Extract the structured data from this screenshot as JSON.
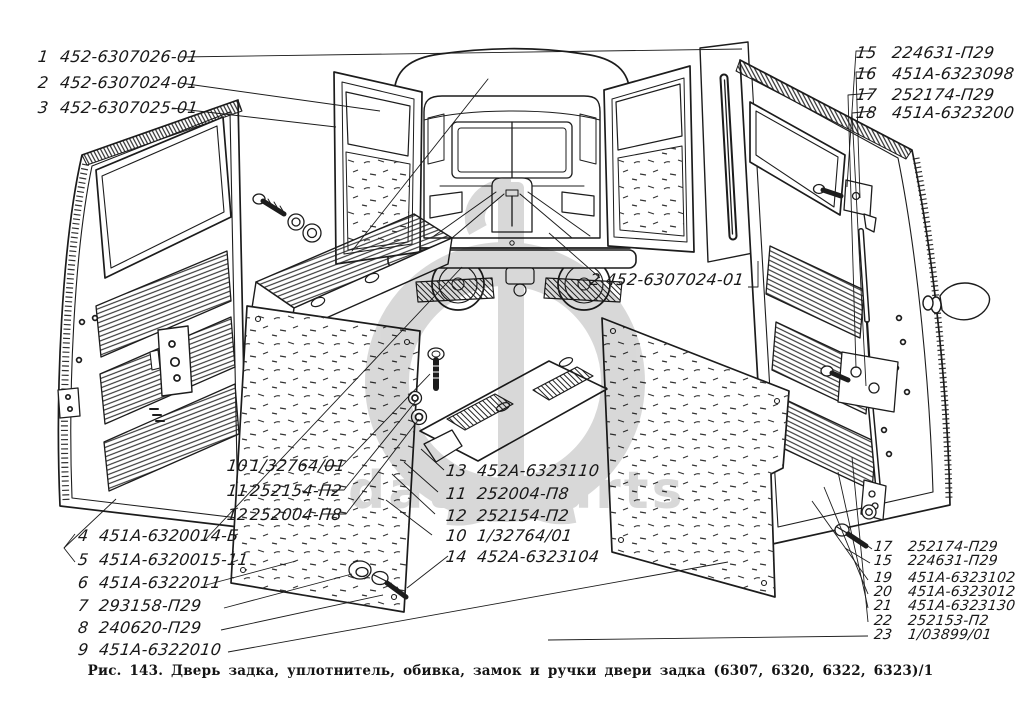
{
  "figure": {
    "caption": "Рис. 143. Дверь задка, уплотнитель, обивка, замок и ручки двери задка (6307, 6320, 6322, 6323)/1"
  },
  "watermark": {
    "text": "data-parts",
    "color": "#d9d9d9"
  },
  "ink_color": "#1c1c1c",
  "callouts": {
    "top_left": [
      {
        "num": "1",
        "part": "452-6307026-01"
      },
      {
        "num": "2",
        "part": "452-6307024-01"
      },
      {
        "num": "3",
        "part": "452-6307025-01"
      }
    ],
    "top_right": [
      {
        "num": "15",
        "part": "224631-П29"
      },
      {
        "num": "16",
        "part": "451А-6323098"
      },
      {
        "num": "17",
        "part": "252174-П29"
      },
      {
        "num": "18",
        "part": "451А-6323200"
      }
    ],
    "mid_right": [
      {
        "num": "2",
        "part": "452-6307024-01"
      }
    ],
    "left_center": [
      {
        "num": "10",
        "part": "1/32764/01"
      },
      {
        "num": "11",
        "part": "252154-П2"
      },
      {
        "num": "12",
        "part": "252004-П8"
      }
    ],
    "center": [
      {
        "num": "13",
        "part": "452А-6323110"
      },
      {
        "num": "11",
        "part": "252004-П8"
      },
      {
        "num": "12",
        "part": "252154-П2"
      },
      {
        "num": "10",
        "part": "1/32764/01"
      },
      {
        "num": "14",
        "part": "452А-6323104"
      }
    ],
    "bottom_left": [
      {
        "num": "4",
        "part": "451А-6320014-Б"
      },
      {
        "num": "5",
        "part": "451А-6320015-11"
      },
      {
        "num": "6",
        "part": "451А-6322011"
      },
      {
        "num": "7",
        "part": "293158-П29"
      },
      {
        "num": "8",
        "part": "240620-П29"
      },
      {
        "num": "9",
        "part": "451А-6322010"
      }
    ],
    "bottom_right": [
      {
        "num": "17",
        "part": "252174-П29"
      },
      {
        "num": "15",
        "part": "224631-П29"
      },
      {
        "num": "19",
        "part": "451А-6323102"
      },
      {
        "num": "20",
        "part": "451А-6323012"
      },
      {
        "num": "21",
        "part": "451А-6323130"
      },
      {
        "num": "22",
        "part": "252153-П2"
      },
      {
        "num": "23",
        "part": "1/03899/01"
      }
    ]
  }
}
